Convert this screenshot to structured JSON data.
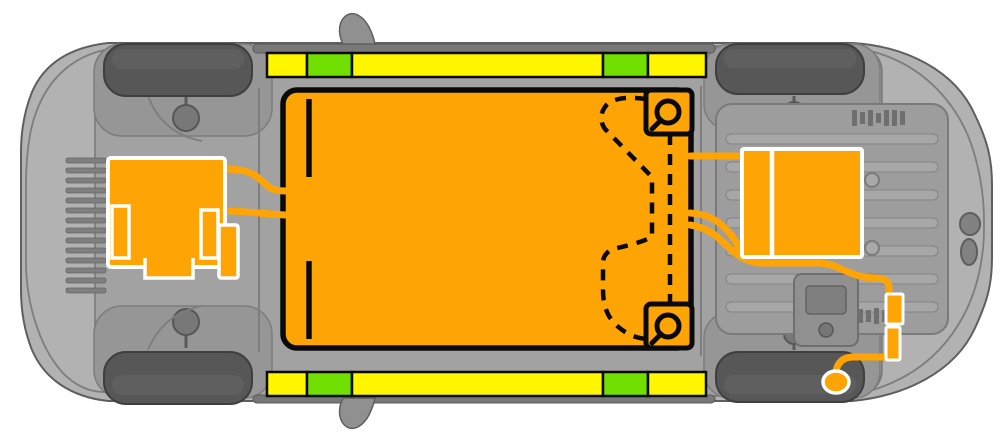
{
  "canvas": {
    "width": 998,
    "height": 442
  },
  "colors": {
    "background": "#ffffff",
    "body_gray": "#b2b2b2",
    "floor_gray": "#a2a2a2",
    "detail_gray": "#8e8e8e",
    "outline_gray": "#5f5f5f",
    "wheel_gray": "#575757",
    "hv_orange": "#ffa405",
    "cut_yellow": "#fff600",
    "caution_green": "#71e000",
    "line_black": "#0a0a0a",
    "component_white": "#ffffff"
  },
  "rocker_strips": {
    "x_start": 267,
    "segment_height": 24,
    "rows": [
      {
        "id": "top",
        "y": 53
      },
      {
        "id": "bottom",
        "y": 372
      }
    ],
    "pattern": [
      {
        "color": "yellow",
        "width": 40
      },
      {
        "color": "green",
        "width": 45
      },
      {
        "color": "yellow",
        "width": 251
      },
      {
        "color": "green",
        "width": 45
      },
      {
        "color": "yellow",
        "width": 58
      }
    ]
  }
}
